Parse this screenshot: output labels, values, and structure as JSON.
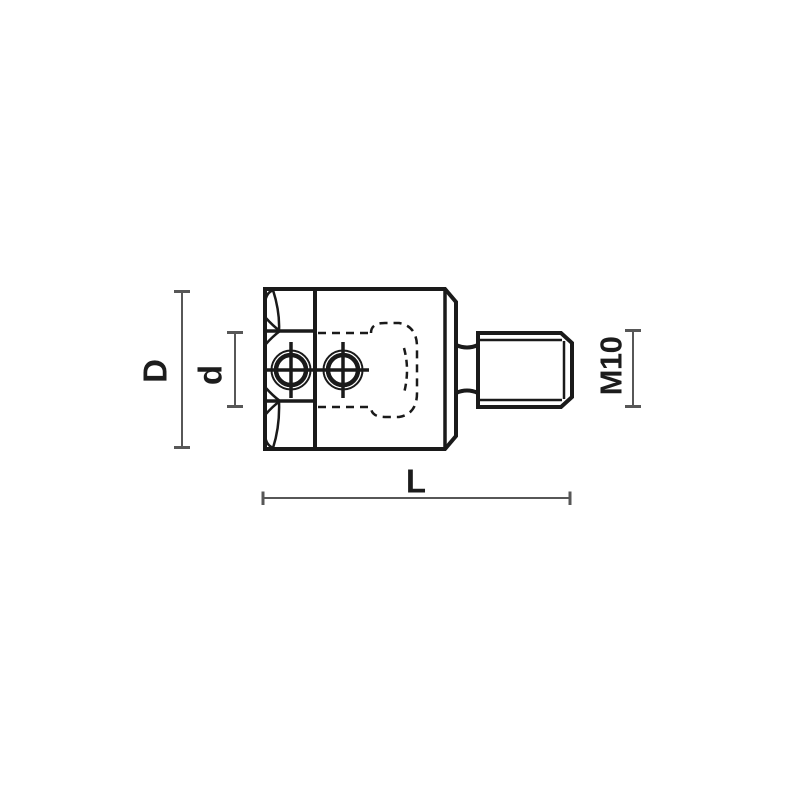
{
  "diagram": {
    "type": "technical-drawing",
    "subject": "hex-shank adapter chuck with threaded arbor, side elevation",
    "labels": {
      "outer_diameter": "D",
      "bore_diameter": "d",
      "overall_length": "L",
      "thread": "M10"
    }
  },
  "colors": {
    "background": "#ffffff",
    "outline": "#1a1a1a",
    "dimension": "#575757",
    "label": "#1c1c1c"
  }
}
